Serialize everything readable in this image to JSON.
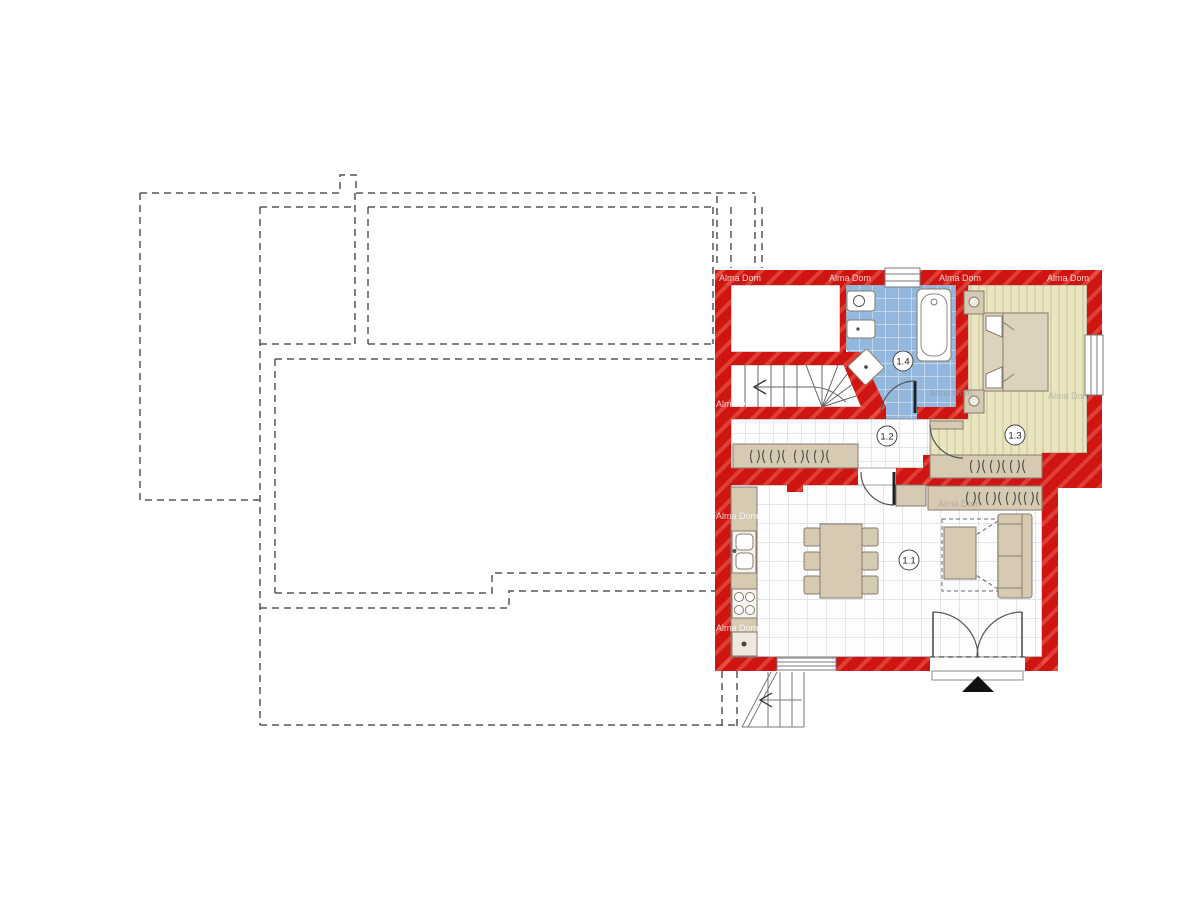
{
  "plan": {
    "type": "floor-plan",
    "watermark_text": "Alma Dom",
    "rooms": [
      {
        "id": "1.1",
        "kind": "living-room-kitchen"
      },
      {
        "id": "1.2",
        "kind": "hallway"
      },
      {
        "id": "1.3",
        "kind": "bedroom"
      },
      {
        "id": "1.4",
        "kind": "bathroom"
      }
    ],
    "colors": {
      "wall": "#ce1512",
      "wall_hatch": "#e85548",
      "bathroom_floor": "#93b7dd",
      "bedroom_floor": "#eae5c1",
      "bedroom_stripe": "#d7d0a2",
      "tile": "#fdfdfe",
      "tile_grid": "#c9ced3",
      "furniture": "#d6cab3",
      "furniture_border": "#857c6c",
      "dashed_outline": "#555555",
      "entrance_marker": "#111111"
    }
  }
}
